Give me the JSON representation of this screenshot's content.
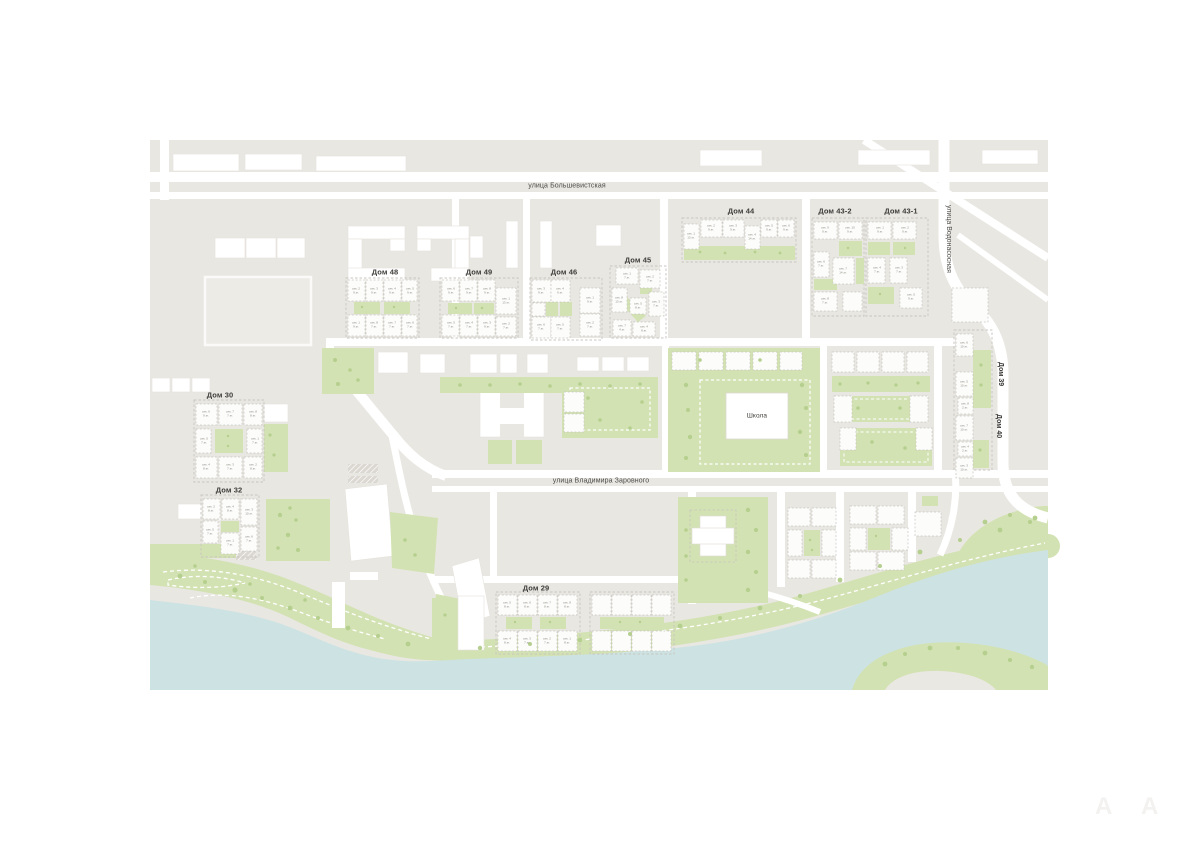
{
  "map": {
    "colors": {
      "land": "#e9e7e2",
      "road": "#ffffff",
      "green": "#d3e2b3",
      "tree": "#b5cf8e",
      "water": "#cde3e3",
      "building": "#ffffff",
      "dashed_outline": "#c8c5be",
      "label": "#3d3c39"
    },
    "streets": [
      {
        "id": "bolshevistskaya",
        "label": "улица Большевистская"
      },
      {
        "id": "zarovnogo",
        "label": "улица Владимира Заровного"
      },
      {
        "id": "vodonasosnaya",
        "label": "улица Водонасосная"
      }
    ],
    "school": {
      "label": "Школа"
    },
    "buildings": [
      {
        "id": "dom44",
        "label": "Дом 44",
        "sections": [
          {
            "name": "сек. 1",
            "floors": "13 эт."
          },
          {
            "name": "сек. 2",
            "floors": "9 эт."
          },
          {
            "name": "сек. 3",
            "floors": "9 эт."
          },
          {
            "name": "сек. 4",
            "floors": "14 эт."
          },
          {
            "name": "сек. 5",
            "floors": "9 эт."
          },
          {
            "name": "сек. 6",
            "floors": "9 эт."
          }
        ]
      },
      {
        "id": "dom43_2",
        "label": "Дом 43-2",
        "sections": [
          {
            "name": "сек. 9",
            "floors": "9 эт."
          },
          {
            "name": "сек. 10",
            "floors": "9 эт."
          },
          {
            "name": "сек. 6",
            "floors": "7 эт."
          },
          {
            "name": "сек. 7",
            "floors": "14 эт."
          },
          {
            "name": "сек. 8",
            "floors": "7 эт."
          }
        ]
      },
      {
        "id": "dom43_1",
        "label": "Дом 43-1",
        "sections": [
          {
            "name": "сек. 1",
            "floors": "9 эт."
          },
          {
            "name": "сек. 2",
            "floors": "9 эт."
          },
          {
            "name": "сек. 4",
            "floors": "7 эт."
          },
          {
            "name": "сек. 3",
            "floors": "7 эт."
          },
          {
            "name": "сек. 5",
            "floors": "9 эт."
          }
        ]
      },
      {
        "id": "dom48",
        "label": "Дом 48",
        "sections": [
          {
            "name": "сек. 2",
            "floors": "9 эт."
          },
          {
            "name": "сек. 3",
            "floors": "9 эт."
          },
          {
            "name": "сек. 4",
            "floors": "9 эт."
          },
          {
            "name": "сек. 5",
            "floors": "9 эт."
          },
          {
            "name": "сек. 1",
            "floors": "9 эт."
          },
          {
            "name": "сек. 8",
            "floors": "7 эт."
          },
          {
            "name": "сек. 7",
            "floors": "7 эт."
          },
          {
            "name": "сек. 6",
            "floors": "7 эт."
          }
        ]
      },
      {
        "id": "dom49",
        "label": "Дом 49",
        "sections": [
          {
            "name": "сек. 6",
            "floors": "9 эт."
          },
          {
            "name": "сек. 7",
            "floors": "9 эт."
          },
          {
            "name": "сек. 8",
            "floors": "9 эт."
          },
          {
            "name": "сек. 1",
            "floors": "13 эт."
          },
          {
            "name": "сек. 5",
            "floors": "7 эт."
          },
          {
            "name": "сек. 4",
            "floors": "7 эт."
          },
          {
            "name": "сек. 3",
            "floors": "9 эт."
          },
          {
            "name": "сек. 2",
            "floors": "7 эт."
          }
        ]
      },
      {
        "id": "dom46",
        "label": "Дом 46",
        "sections": [
          {
            "name": "сек. 3",
            "floors": "9 эт."
          },
          {
            "name": "сек. 4",
            "floors": "9 эт."
          },
          {
            "name": "сек. 1",
            "floors": "9 эт."
          },
          {
            "name": "сек. 2",
            "floors": "7 эт."
          },
          {
            "name": "сек. 6",
            "floors": "7 эт."
          },
          {
            "name": "сек. 5",
            "floors": "7 эт."
          }
        ]
      },
      {
        "id": "dom45",
        "label": "Дом 45",
        "sections": [
          {
            "name": "сек. 1",
            "floors": "7 эт."
          },
          {
            "name": "сек. 2",
            "floors": "7 эт."
          },
          {
            "name": "сек. 8",
            "floors": "13 эт."
          },
          {
            "name": "сек. 3",
            "floors": "7 эт."
          },
          {
            "name": "сек. 7",
            "floors": "4 эт."
          },
          {
            "name": "сек. 4",
            "floors": "8 эт."
          },
          {
            "name": "сек. 5",
            "floors": "8 эт."
          }
        ]
      },
      {
        "id": "dom30",
        "label": "Дом 30",
        "sections": [
          {
            "name": "сек. 6",
            "floors": "9 эт."
          },
          {
            "name": "сек. 7",
            "floors": "7 эт."
          },
          {
            "name": "сек. 8",
            "floors": "8 эт."
          },
          {
            "name": "сек. 5",
            "floors": "7 эт."
          },
          {
            "name": "сек. 1",
            "floors": "7 эт."
          },
          {
            "name": "сек. 4",
            "floors": "8 эт."
          },
          {
            "name": "сек. 3",
            "floors": "7 эт."
          },
          {
            "name": "сек. 2",
            "floors": "8 эт."
          }
        ]
      },
      {
        "id": "dom32",
        "label": "Дом 32",
        "sections": [
          {
            "name": "сек. 2",
            "floors": "8 эт."
          },
          {
            "name": "сек. 4",
            "floors": "8 эт."
          },
          {
            "name": "сек. 3",
            "floors": "10 эт."
          },
          {
            "name": "сек. 5",
            "floors": "7 эт."
          },
          {
            "name": "сек. 1",
            "floors": "7 эт."
          },
          {
            "name": "сек. 6",
            "floors": "7 эт."
          }
        ]
      },
      {
        "id": "dom29",
        "label": "Дом 29",
        "sections": [
          {
            "name": "сек. 5",
            "floors": "8 эт."
          },
          {
            "name": "сек. 6",
            "floors": "8 эт."
          },
          {
            "name": "сек. 7",
            "floors": "8 эт."
          },
          {
            "name": "сек. 8",
            "floors": "8 эт."
          },
          {
            "name": "сек. 4",
            "floors": "8 эт."
          },
          {
            "name": "сек. 3",
            "floors": "7 эт."
          },
          {
            "name": "сек. 2",
            "floors": "7 эт."
          },
          {
            "name": "сек. 1",
            "floors": "8 эт."
          }
        ]
      },
      {
        "id": "dom39",
        "label": "Дом 39",
        "sections": [
          {
            "name": "сек. 6",
            "floors": "10 эт."
          },
          {
            "name": "сек. 5",
            "floors": "10 эт."
          },
          {
            "name": "сек. 8",
            "floors": "2 эт."
          },
          {
            "name": "сек. 7",
            "floors": "10 эт."
          },
          {
            "name": "сек. 4",
            "floors": "2 эт."
          },
          {
            "name": "сек. 3",
            "floors": "10 эт."
          }
        ]
      },
      {
        "id": "dom40",
        "label": "Дом 40",
        "sections": []
      }
    ],
    "watermark": {
      "letters": [
        "A",
        "A"
      ]
    }
  }
}
